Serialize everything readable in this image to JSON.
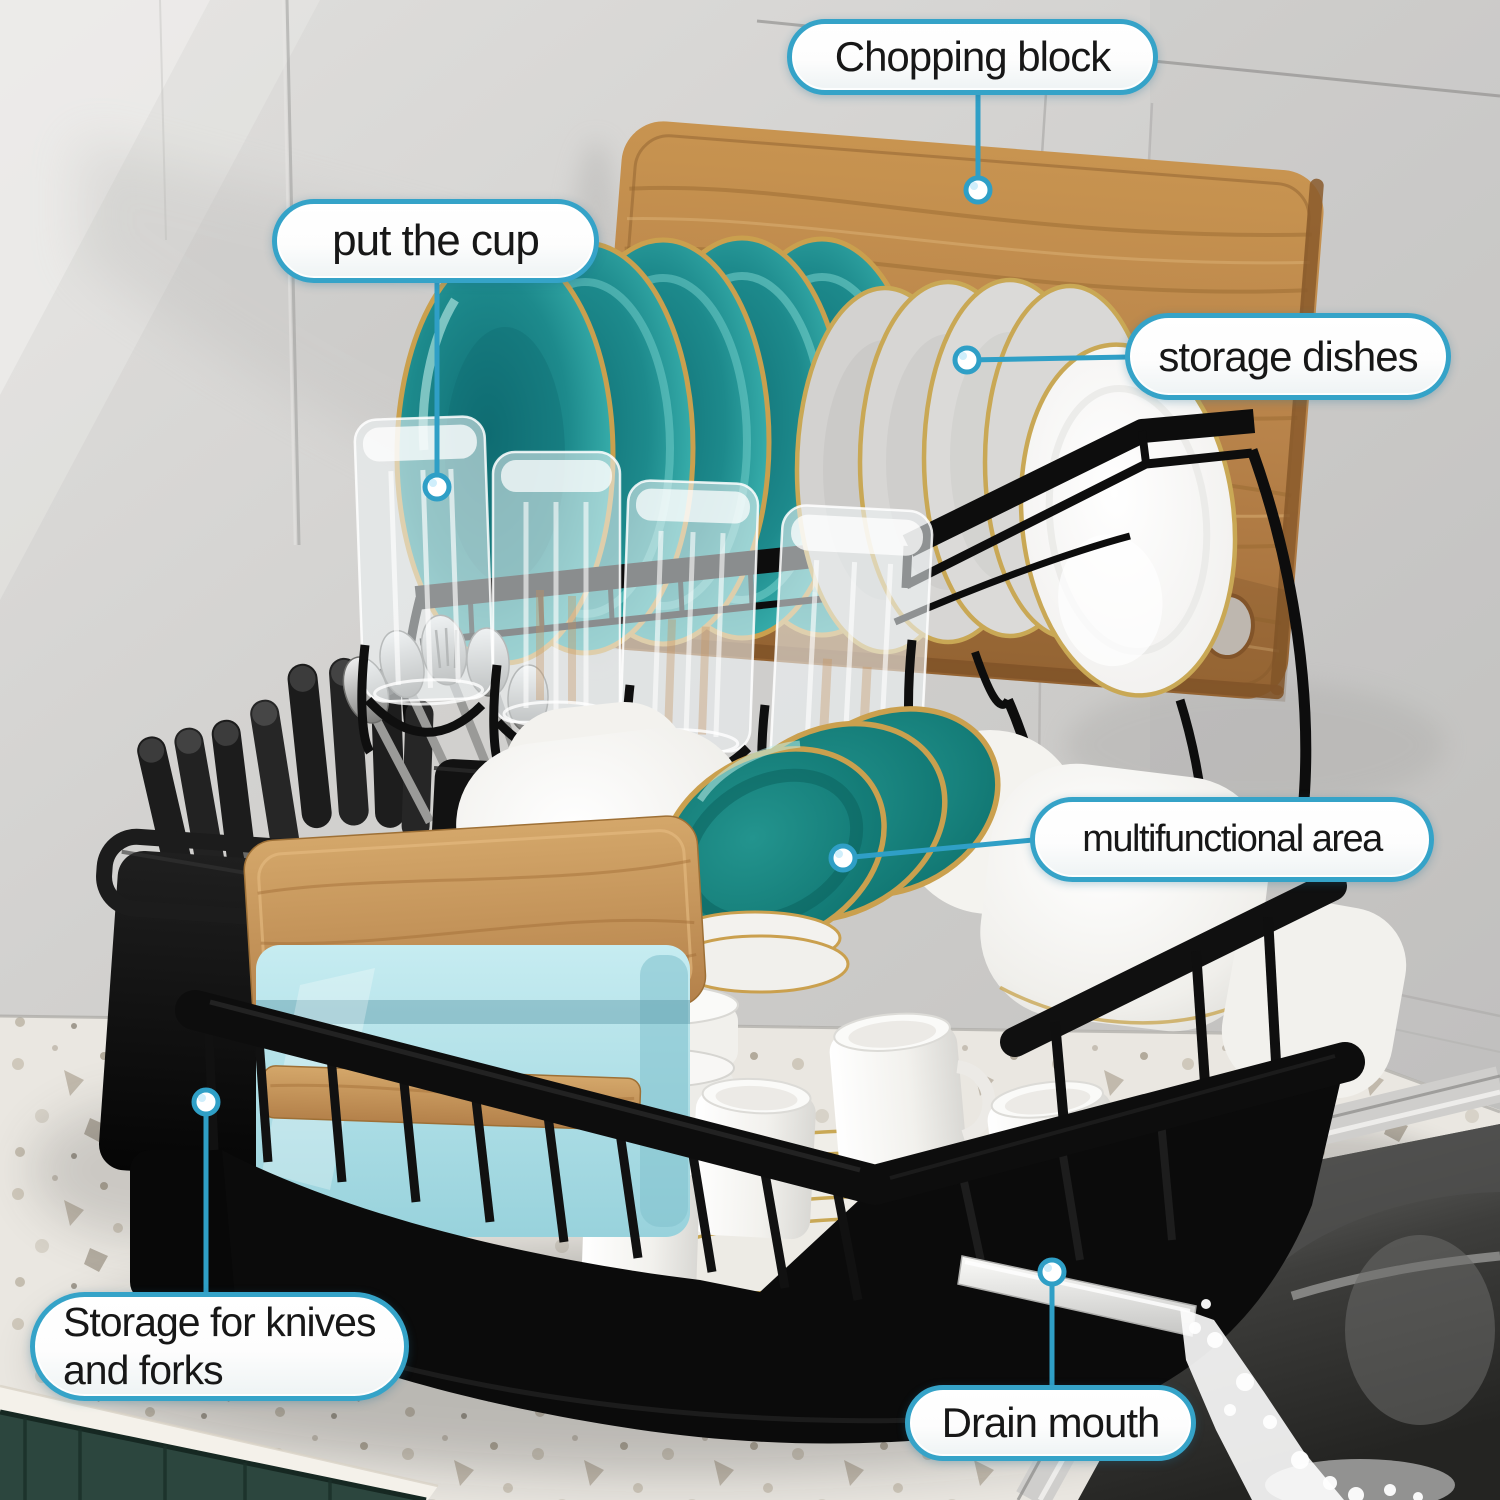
{
  "callouts": [
    {
      "id": "chopping-block",
      "label": "Chopping block"
    },
    {
      "id": "put-the-cup",
      "label": "put the cup"
    },
    {
      "id": "storage-dishes",
      "label": "storage dishes"
    },
    {
      "id": "multifunctional-area",
      "label": "multifunctional area"
    },
    {
      "id": "storage-knives-forks",
      "label": "Storage for knives and forks"
    },
    {
      "id": "drain-mouth",
      "label": "Drain mouth"
    }
  ],
  "colors": {
    "callout-border": "#35a3c8",
    "callout-text": "#171717",
    "leader-line": "#2f9fc6",
    "rack-black": "#0d0d0d",
    "plate-teal": "#2a9a98",
    "gold-rim": "#c9a855",
    "wood": "#b5803f",
    "container-blue": "#aadde6",
    "cabinet-green": "#2c463e",
    "counter": "#eae7e1"
  }
}
